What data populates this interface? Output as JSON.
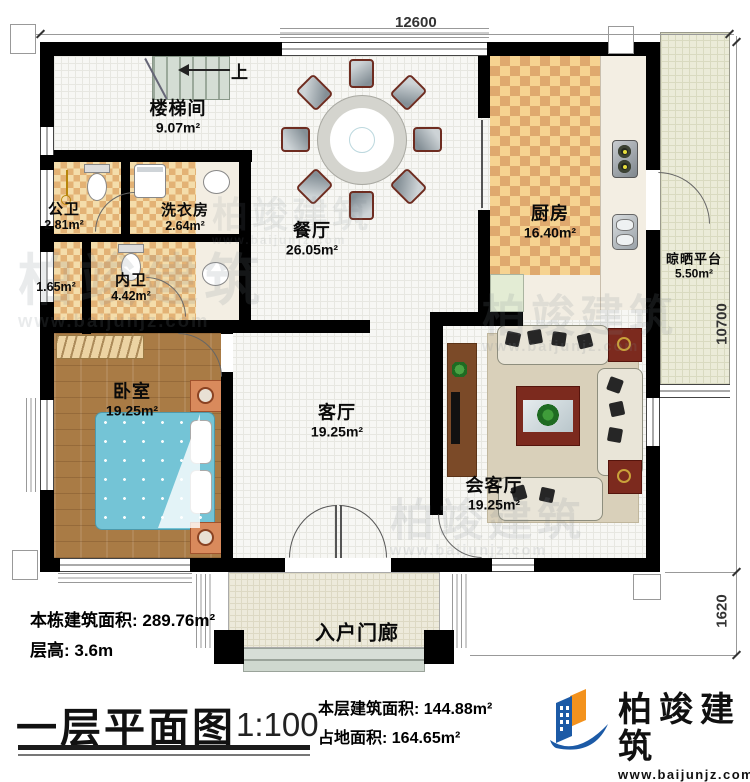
{
  "dimensions": {
    "top": "12600",
    "right": "10700",
    "porch": "1620"
  },
  "stairs": {
    "up_label": "上"
  },
  "rooms": {
    "stairwell": {
      "name": "楼梯间",
      "area": "9.07m²"
    },
    "public_bath": {
      "name": "公卫",
      "area": "2.81m²"
    },
    "laundry": {
      "name": "洗衣房",
      "area": "2.64m²"
    },
    "closet": {
      "area": "1.65m²"
    },
    "private_bath": {
      "name": "内卫",
      "area": "4.42m²"
    },
    "dining": {
      "name": "餐厅",
      "area": "26.05m²"
    },
    "kitchen": {
      "name": "厨房",
      "area": "16.40m²"
    },
    "platform": {
      "name": "晾晒平台",
      "area": "5.50m²"
    },
    "bedroom": {
      "name": "卧室",
      "area": "19.25m²"
    },
    "living": {
      "name": "客厅",
      "area": "19.25m²"
    },
    "reception": {
      "name": "会客厅",
      "area": "19.25m²"
    },
    "porch": {
      "name": "入户门廊"
    }
  },
  "stats": {
    "building_total": "本栋建筑面积: 289.76m²",
    "floor_height": "层高: 3.6m"
  },
  "footer": {
    "title": "一层平面图",
    "scale": "1:100",
    "floor_area": "本层建筑面积: 144.88m²",
    "land_area": "占地面积: 164.65m²"
  },
  "brand": {
    "name": "柏竣建筑",
    "url": "www.baijunjz.com",
    "blue": "#1c5aa6",
    "orange": "#f3921d"
  },
  "watermark": {
    "name": "柏竣建筑",
    "url": "www.baijunjz.com"
  }
}
